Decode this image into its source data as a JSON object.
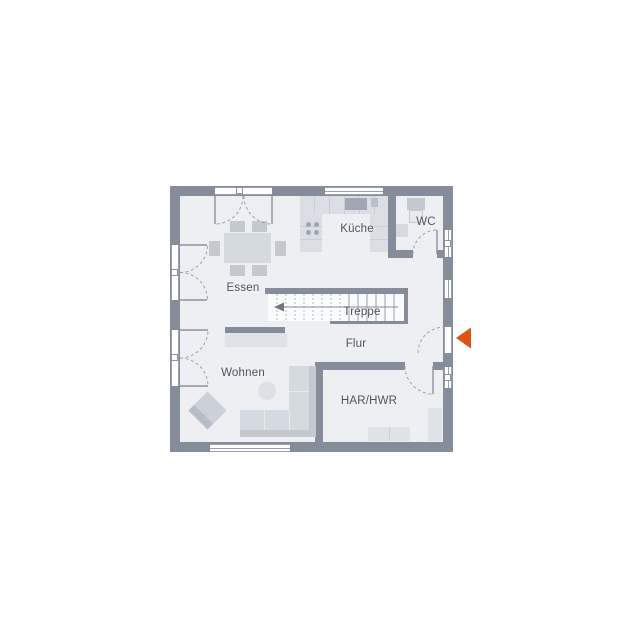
{
  "floorplan": {
    "labels": {
      "kueche": "Küche",
      "wc": "WC",
      "essen": "Essen",
      "treppe": "Treppe",
      "flur": "Flur",
      "wohnen": "Wohnen",
      "har_hwr": "HAR/HWR"
    },
    "colors": {
      "wall": "#868d9a",
      "floor": "#edeff3",
      "stair_fill": "#fafbfd",
      "furniture": "#d5d9e0",
      "furniture_dark": "#c3c8d1",
      "fixture_dark": "#a0a7b2",
      "accent": "#dd5316",
      "text": "#4b515a",
      "background": "#ffffff"
    }
  }
}
